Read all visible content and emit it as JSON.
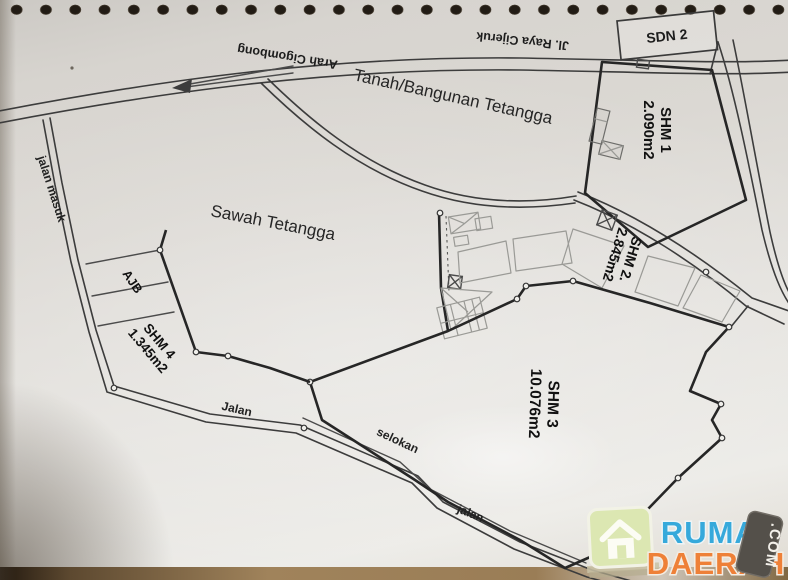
{
  "map": {
    "roads": {
      "main_road_label": "Jl. Raya Cijeruk",
      "direction_label": "Arah Cigombong",
      "access_road_label": "jalan masuk",
      "west_road_label": "Jalan",
      "ditch_label": "selokan",
      "south_road_label": "jalan"
    },
    "areas": {
      "school_label": "SDN 2",
      "neighbor_land_label": "Tanah/Bangunan Tetangga",
      "neighbor_field_label": "Sawah Tetangga",
      "deed_parcel_label": "AJB"
    },
    "parcels": [
      {
        "id": "SHM 1",
        "area": "2.090m2"
      },
      {
        "id": "SHM 2.",
        "area": "2.845m2"
      },
      {
        "id": "SHM 3",
        "area": "10.076m2"
      },
      {
        "id": "SHM 4",
        "area": "1.345m2"
      }
    ]
  },
  "watermark": {
    "brand_top": "RUMAH",
    "brand_bottom": "DAERAH",
    "brand_suffix": ".COM",
    "colors": {
      "blue": "#36a9db",
      "orange": "#ee8038",
      "tag_bg": "#54504a",
      "house_bg": "#dce7b2"
    }
  }
}
